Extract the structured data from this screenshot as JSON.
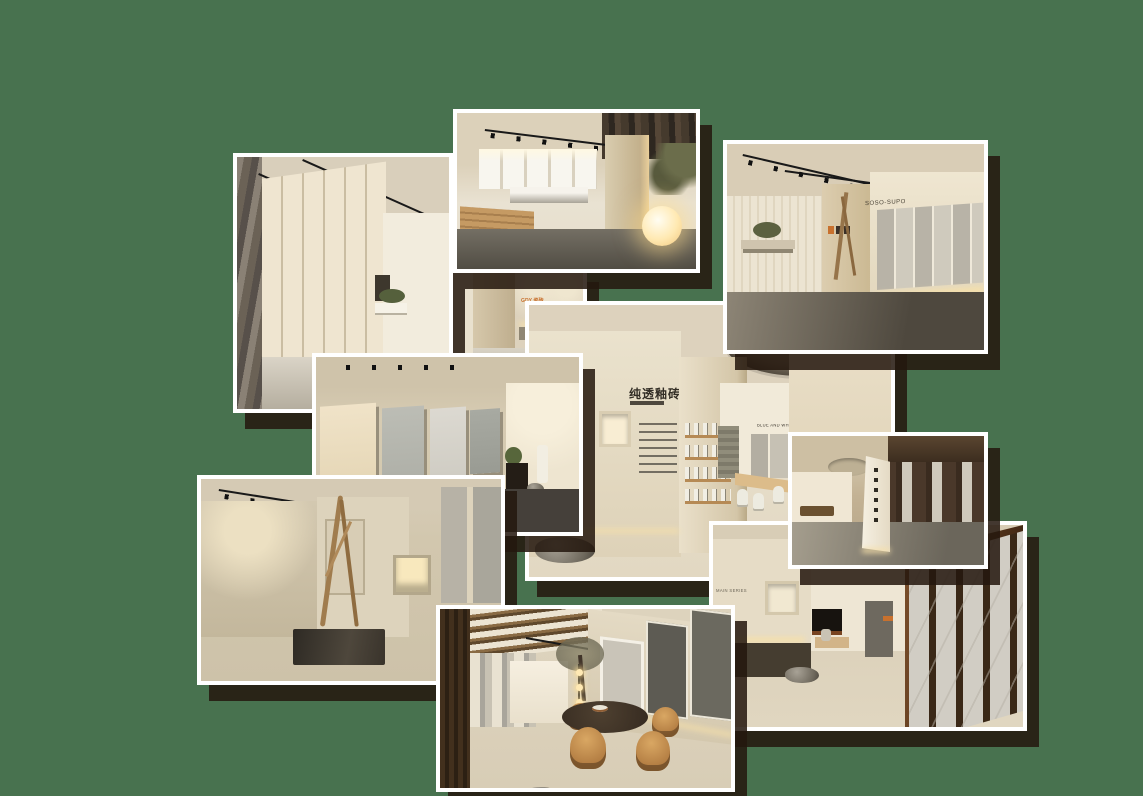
{
  "collage": {
    "background_color": "#48724F",
    "photo_border_color": "#FFFFFF",
    "shadow_color": "rgba(36,23,14,0.86)",
    "accent_orange": "#C8712E",
    "warm_glow": "#F6E0AA",
    "photos": [
      {
        "name": "backdrop-showroom",
        "logo_text": "GDY 瓷砖"
      },
      {
        "name": "tall-gallery-corridor"
      },
      {
        "name": "sphere-lamp-showroom"
      },
      {
        "name": "brand-wall-showroom",
        "wall_text": "SOSO-SUPO"
      },
      {
        "name": "oculus-hall",
        "wall_title": "纯透釉砖",
        "corridor_label": "BLUE AND WHITE"
      },
      {
        "name": "panel-display-room"
      },
      {
        "name": "calligraphy-partition-hall"
      },
      {
        "name": "branch-installation-room"
      },
      {
        "name": "dining-table-showroom"
      },
      {
        "name": "slab-corridor",
        "series_label": "MAIN SERIES"
      }
    ]
  }
}
